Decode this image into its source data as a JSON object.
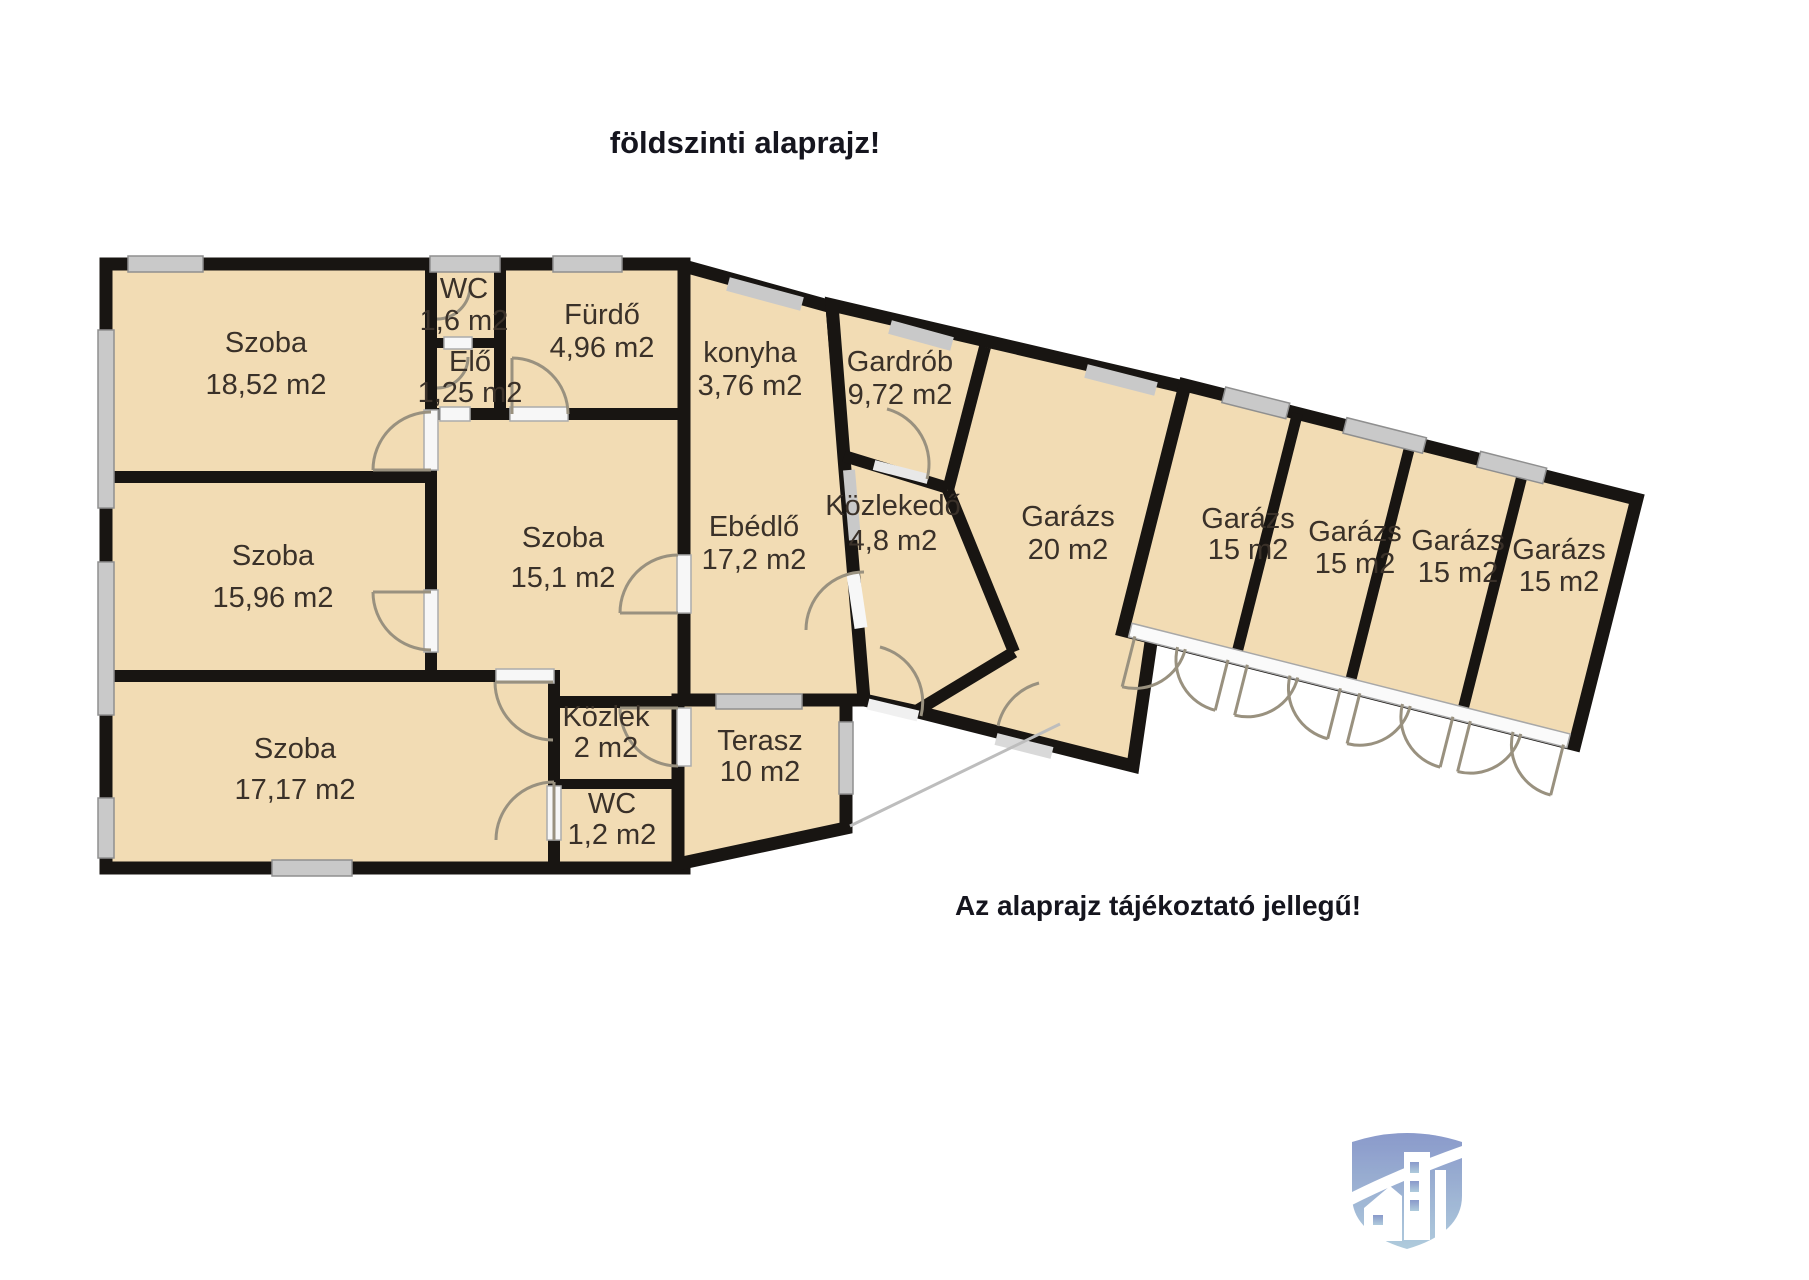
{
  "title": "földszinti alaprajz!",
  "note": "Az alaprajz tájékoztató jellegű!",
  "colors": {
    "room_fill": "#f2dcb4",
    "wall": "#181512",
    "window_gray": "#c9c9c9",
    "door_arc": "#99917f",
    "label_text": "#3a3129",
    "heading_text": "#15151e",
    "logo_gradient_top": "#8091c6",
    "logo_gradient_bottom": "#a9c7da"
  },
  "logo": {
    "icon": "shield-building-logo"
  },
  "rooms": [
    {
      "id": "szoba-1",
      "name": "Szoba",
      "area": "18,52 m2",
      "x": 266,
      "y1": 352,
      "y2": 394
    },
    {
      "id": "wc-1",
      "name": "WC",
      "area": "1,6 m2",
      "x": 464,
      "y1": 298,
      "y2": 330
    },
    {
      "id": "elo",
      "name": "Elő",
      "area": "1,25 m2",
      "x": 470,
      "y1": 371,
      "y2": 402
    },
    {
      "id": "furdo",
      "name": "Fürdő",
      "area": "4,96 m2",
      "x": 602,
      "y1": 324,
      "y2": 357
    },
    {
      "id": "konyha",
      "name": "konyha",
      "area": "3,76 m2",
      "x": 750,
      "y1": 362,
      "y2": 395
    },
    {
      "id": "gardrob",
      "name": "Gardrób",
      "area": "9,72 m2",
      "x": 900,
      "y1": 371,
      "y2": 404
    },
    {
      "id": "szoba-2",
      "name": "Szoba",
      "area": "15,96 m2",
      "x": 273,
      "y1": 565,
      "y2": 607
    },
    {
      "id": "szoba-3",
      "name": "Szoba",
      "area": "15,1 m2",
      "x": 563,
      "y1": 547,
      "y2": 587
    },
    {
      "id": "ebedlo",
      "name": "Ebédlő",
      "area": "17,2 m2",
      "x": 754,
      "y1": 536,
      "y2": 569
    },
    {
      "id": "kozlekedo",
      "name": "Közlekedő",
      "area": "4,8 m2",
      "x": 893,
      "y1": 515,
      "y2": 550
    },
    {
      "id": "garazs-20",
      "name": "Garázs",
      "area": "20 m2",
      "x": 1068,
      "y1": 526,
      "y2": 559
    },
    {
      "id": "szoba-4",
      "name": "Szoba",
      "area": "17,17 m2",
      "x": 295,
      "y1": 758,
      "y2": 799
    },
    {
      "id": "kozlek",
      "name": "Közlek",
      "area": "2 m2",
      "x": 606,
      "y1": 726,
      "y2": 757
    },
    {
      "id": "terasz",
      "name": "Terasz",
      "area": "10 m2",
      "x": 760,
      "y1": 750,
      "y2": 781
    },
    {
      "id": "wc-2",
      "name": "WC",
      "area": "1,2 m2",
      "x": 612,
      "y1": 813,
      "y2": 844
    },
    {
      "id": "garazs-15a",
      "name": "Garázs",
      "area": "15 m2",
      "x": 1248,
      "y1": 528,
      "y2": 559
    },
    {
      "id": "garazs-15b",
      "name": "Garázs",
      "area": "15 m2",
      "x": 1355,
      "y1": 541,
      "y2": 573
    },
    {
      "id": "garazs-15c",
      "name": "Garázs",
      "area": "15 m2",
      "x": 1458,
      "y1": 550,
      "y2": 582
    },
    {
      "id": "garazs-15d",
      "name": "Garázs",
      "area": "15 m2",
      "x": 1559,
      "y1": 559,
      "y2": 591
    }
  ]
}
